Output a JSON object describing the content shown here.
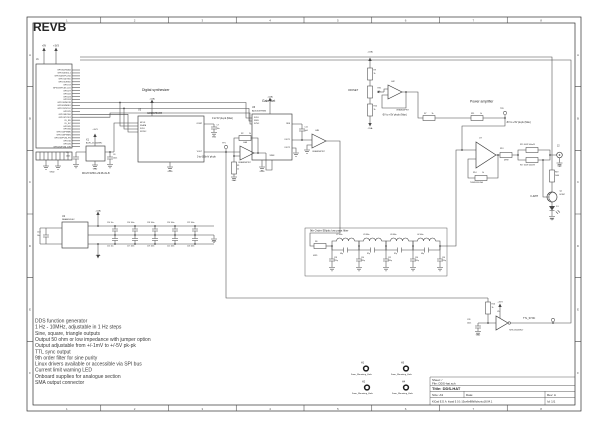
{
  "rev_label": "REVB",
  "features": [
    "DDS function generator",
    "1 Hz - 10MHz, adjustable in 1 Hz steps",
    "Sine, square, triangle outputs",
    "Output 50 ohm or low impedance with jumper option",
    "Output adjustable from +/-1mV to +/-5V pk-pk",
    "TTL sync output",
    "9th order filter for sine purity",
    "Linux drivers available or accessible via SPI bus",
    "Current limit warning LED",
    "Onboard supplies for analogue section",
    "SMA output connector"
  ],
  "title_block": {
    "sheet": "Sheet: /",
    "file": "File: DDS-hat.sch",
    "title": "Title: DDS-HAT",
    "size": "Size: A3",
    "date": "Date:",
    "rev": "Rev: A",
    "tool": "KiCad E.D.A.  kicad 5.0.1-15ce6e88b8ubuntu18.04.1",
    "id": "Id: 1/1"
  },
  "frame": {
    "cols": [
      "1",
      "2",
      "3",
      "4",
      "5",
      "6",
      "7",
      "8"
    ],
    "rows": [
      "A",
      "B",
      "C",
      "D",
      "E",
      "F"
    ]
  },
  "gpio_header": {
    "pins": [
      "GPIO02/SDA1",
      "GPIO03/SCL1",
      "GPIO04/GPCLK0",
      "GPIO14/TXD",
      "GPIO15/RXD",
      "GPIO17",
      "GPIO18/PCM_CLK",
      "GPIO27",
      "GPIO22",
      "GPIO23",
      "GPIO24",
      "GPIO10/MOSI",
      "GPIO09/MISO",
      "GPIO11/SCLK",
      "GPIO25",
      "GPIO08/CE0",
      "GPIO07/CE1",
      "ID_SD",
      "ID_SC",
      "GPIO05",
      "GPIO06",
      "GPIO12/PWM0",
      "GPIO13/PWM1",
      "GPIO19/PCM_FS",
      "GPIO16",
      "GPIO26",
      "GPIO20/PCM_DIN"
    ]
  },
  "colors": {
    "line": "#474747",
    "text": "#262626",
    "frame": "#2f2f2f"
  },
  "labels": [
    {
      "t": "REVB",
      "x": 33,
      "y": 21,
      "fs": 12,
      "b": 1,
      "n": "rev-label"
    },
    {
      "t": "Digital synthesizer",
      "x": 142,
      "y": 88,
      "fs": 3.4,
      "n": "label-digital-synthesizer"
    },
    {
      "t": "Gain Set",
      "x": 262,
      "y": 99,
      "fs": 3.4,
      "n": "label-gain-set"
    },
    {
      "t": "Power amplifier",
      "x": 470,
      "y": 99.5,
      "fs": 3.4,
      "n": "label-power-amplifier"
    },
    {
      "t": "9th Order Elliptic low pass filter",
      "x": 310,
      "y": 229,
      "fs": 2.8,
      "n": "label-filter"
    },
    {
      "t": "0 to 600mV pk-pk",
      "x": 197,
      "y": 155.5,
      "fs": 2.4
    },
    {
      "t": "0 to 5V pk-pk (Max)",
      "x": 212,
      "y": 117,
      "fs": 2.4
    },
    {
      "t": "-5V to +5V pk-pk (Max)",
      "x": 382,
      "y": 113.5,
      "fs": 2.4
    },
    {
      "t": "-5V to +5V pk-pk (Max)",
      "x": 506,
      "y": 121,
      "fs": 2.4
    },
    {
      "t": "OFFSET",
      "x": 348,
      "y": 89,
      "fs": 2.6
    },
    {
      "t": "I LIMIT",
      "x": 530,
      "y": 195,
      "fs": 2.6
    },
    {
      "t": "MCLH-WHC1-29.08-JG-B",
      "x": 82,
      "y": 172,
      "fs": 2.4
    },
    {
      "t": "J1",
      "x": 36,
      "y": 58,
      "fs": 2.6
    },
    {
      "t": "+5V",
      "x": 44,
      "y": 44.5,
      "fs": 2.4,
      "a": "m"
    },
    {
      "t": "+3V3",
      "x": 56,
      "y": 44.5,
      "fs": 2.4,
      "a": "m"
    },
    {
      "t": "GND",
      "x": 52,
      "y": 170.5,
      "fs": 2.2,
      "a": "m"
    },
    {
      "t": "X1",
      "x": 86,
      "y": 138.5,
      "fs": 2.4
    },
    {
      "t": "ACHL-25.000MHz",
      "x": 86,
      "y": 141.8,
      "fs": 2
    },
    {
      "t": "+3V3",
      "x": 95,
      "y": 128,
      "fs": 2.2,
      "a": "m"
    },
    {
      "t": "C5",
      "x": 66,
      "y": 151.5,
      "fs": 1.9
    },
    {
      "t": "100n",
      "x": 66,
      "y": 154.8,
      "fs": 1.9
    },
    {
      "t": "C6",
      "x": 113,
      "y": 153.5,
      "fs": 1.9
    },
    {
      "t": "100n",
      "x": 113,
      "y": 156.8,
      "fs": 1.9
    },
    {
      "t": "GND",
      "x": 95,
      "y": 168,
      "fs": 2,
      "a": "m"
    },
    {
      "t": "U3",
      "x": 138,
      "y": 108.5,
      "fs": 2.4
    },
    {
      "t": "AD9837BCPZ",
      "x": 147,
      "y": 112.2,
      "fs": 2.4
    },
    {
      "t": "MCLK",
      "x": 140,
      "y": 121.6,
      "fs": 1.9
    },
    {
      "t": "SDATA",
      "x": 140,
      "y": 124.6,
      "fs": 1.9
    },
    {
      "t": "SCLK",
      "x": 140,
      "y": 127.6,
      "fs": 1.9
    },
    {
      "t": "FSYNC",
      "x": 140,
      "y": 130.6,
      "fs": 1.9
    },
    {
      "t": "COMP",
      "x": 202,
      "y": 122.6,
      "fs": 1.9,
      "a": "e"
    },
    {
      "t": "VOUT",
      "x": 202,
      "y": 150.6,
      "fs": 1.9,
      "a": "e"
    },
    {
      "t": "+5VA",
      "x": 152,
      "y": 97.5,
      "fs": 2.2,
      "a": "m"
    },
    {
      "t": "C7",
      "x": 216.5,
      "y": 124,
      "fs": 1.9
    },
    {
      "t": "10n",
      "x": 216.5,
      "y": 127.3,
      "fs": 1.9
    },
    {
      "t": "GND",
      "x": 214,
      "y": 136,
      "fs": 1.9,
      "a": "m"
    },
    {
      "t": "TP1",
      "x": 222,
      "y": 142,
      "fs": 2
    },
    {
      "t": "GND",
      "x": 170,
      "y": 170,
      "fs": 2.2,
      "a": "m"
    },
    {
      "t": "U4A",
      "x": 243,
      "y": 141.5,
      "fs": 2
    },
    {
      "t": "OPA4820IPWT",
      "x": 238,
      "y": 161.5,
      "fs": 1.9
    },
    {
      "t": "R2",
      "x": 241,
      "y": 132.6,
      "fs": 1.9
    },
    {
      "t": "2k",
      "x": 249,
      "y": 132.6,
      "fs": 1.9
    },
    {
      "t": "R1",
      "x": 237,
      "y": 164.5,
      "fs": 1.9
    },
    {
      "t": "1k",
      "x": 237,
      "y": 167.8,
      "fs": 1.9
    },
    {
      "t": "GND",
      "x": 234,
      "y": 179.5,
      "fs": 2,
      "a": "m"
    },
    {
      "t": "U6",
      "x": 252,
      "y": 106,
      "fs": 2.4
    },
    {
      "t": "AD5453YRMZ",
      "x": 252,
      "y": 109.6,
      "fs": 2.2
    },
    {
      "t": "SCLK",
      "x": 254,
      "y": 116.6,
      "fs": 1.9
    },
    {
      "t": "SDIN",
      "x": 254,
      "y": 119.6,
      "fs": 1.9
    },
    {
      "t": "SYNC",
      "x": 254,
      "y": 122.6,
      "fs": 1.9
    },
    {
      "t": "RFB",
      "x": 290,
      "y": 122.6,
      "fs": 1.9,
      "a": "e"
    },
    {
      "t": "IOUT1",
      "x": 290,
      "y": 138.6,
      "fs": 1.9,
      "a": "e"
    },
    {
      "t": "IOUT2",
      "x": 290,
      "y": 146.6,
      "fs": 1.9,
      "a": "e"
    },
    {
      "t": "VREF",
      "x": 272,
      "y": 154.6,
      "fs": 1.9,
      "a": "m"
    },
    {
      "t": "+5VA",
      "x": 270,
      "y": 95.5,
      "fs": 2.2,
      "a": "m"
    },
    {
      "t": "GND",
      "x": 262,
      "y": 170,
      "fs": 2.2,
      "a": "m"
    },
    {
      "t": "C11",
      "x": 304.5,
      "y": 126,
      "fs": 1.9
    },
    {
      "t": "6p8",
      "x": 304.5,
      "y": 129.3,
      "fs": 1.9
    },
    {
      "t": "U4B",
      "x": 315,
      "y": 129.5,
      "fs": 2
    },
    {
      "t": "OPA4820IPWT",
      "x": 312,
      "y": 150.5,
      "fs": 1.9
    },
    {
      "t": "+5VA",
      "x": 370,
      "y": 50.5,
      "fs": 2.2,
      "a": "m"
    },
    {
      "t": "R9",
      "x": 373.5,
      "y": 69,
      "fs": 1.9
    },
    {
      "t": "1k",
      "x": 373.5,
      "y": 72.3,
      "fs": 1.9
    },
    {
      "t": "RV1",
      "x": 377.5,
      "y": 87,
      "fs": 1.9
    },
    {
      "t": "10k",
      "x": 377.5,
      "y": 90.3,
      "fs": 1.9
    },
    {
      "t": "R10",
      "x": 373.5,
      "y": 105,
      "fs": 1.9
    },
    {
      "t": "1k",
      "x": 373.5,
      "y": 108.3,
      "fs": 1.9
    },
    {
      "t": "-5VA",
      "x": 370,
      "y": 127,
      "fs": 2.2,
      "a": "m"
    },
    {
      "t": "U4C",
      "x": 391,
      "y": 80.5,
      "fs": 2
    },
    {
      "t": "OPA4820IPWT",
      "x": 396,
      "y": 109,
      "fs": 1.9
    },
    {
      "t": "R7",
      "x": 424,
      "y": 112.3,
      "fs": 1.9
    },
    {
      "t": "1k",
      "x": 431.5,
      "y": 112.3,
      "fs": 1.9
    },
    {
      "t": "R11",
      "x": 471,
      "y": 112.3,
      "fs": 1.9
    },
    {
      "t": "1k",
      "x": 480,
      "y": 112.3,
      "fs": 1.9
    },
    {
      "t": "TP6",
      "x": 500,
      "y": 107.5,
      "fs": 2
    },
    {
      "t": "U7",
      "x": 479,
      "y": 136.5,
      "fs": 2.2
    },
    {
      "t": "THS3091DDA",
      "x": 470,
      "y": 181.5,
      "fs": 2
    },
    {
      "t": "R14",
      "x": 473,
      "y": 171.5,
      "fs": 1.9
    },
    {
      "t": "1k",
      "x": 482,
      "y": 171.5,
      "fs": 1.9
    },
    {
      "t": "R13",
      "x": 500,
      "y": 147.5,
      "fs": 1.9
    },
    {
      "t": "49R9",
      "x": 504,
      "y": 159,
      "fs": 1.9
    },
    {
      "t": "R15 100R 500mW",
      "x": 520,
      "y": 143.5,
      "fs": 1.8
    },
    {
      "t": "R17 100R 500mW",
      "x": 520,
      "y": 163.8,
      "fs": 1.8
    },
    {
      "t": "J2",
      "x": 557,
      "y": 144.5,
      "fs": 2.4
    },
    {
      "t": "GND",
      "x": 559.5,
      "y": 165,
      "fs": 2,
      "a": "m"
    },
    {
      "t": "R19",
      "x": 555,
      "y": 171,
      "fs": 1.9
    },
    {
      "t": "1k00",
      "x": 555,
      "y": 174.3,
      "fs": 1.9
    },
    {
      "t": "Q1",
      "x": 559.5,
      "y": 190,
      "fs": 2
    },
    {
      "t": "BC847",
      "x": 559.5,
      "y": 193.3,
      "fs": 1.8
    },
    {
      "t": "D1",
      "x": 556,
      "y": 205.5,
      "fs": 2
    },
    {
      "t": "GND",
      "x": 552,
      "y": 218,
      "fs": 2,
      "a": "m"
    },
    {
      "t": "R16",
      "x": 491.5,
      "y": 303,
      "fs": 1.9
    },
    {
      "t": "1k",
      "x": 491.5,
      "y": 306.3,
      "fs": 1.9
    },
    {
      "t": "+3V3",
      "x": 500,
      "y": 300.5,
      "fs": 2.2,
      "a": "m"
    },
    {
      "t": "C26",
      "x": 467,
      "y": 318.5,
      "fs": 1.9
    },
    {
      "t": "100n",
      "x": 467,
      "y": 321.8,
      "fs": 1.9
    },
    {
      "t": "GND",
      "x": 478,
      "y": 334,
      "fs": 2,
      "a": "m"
    },
    {
      "t": "U5",
      "x": 497,
      "y": 310.5,
      "fs": 2
    },
    {
      "t": "74HC1G04GW-T",
      "x": 509,
      "y": 329,
      "fs": 1.9
    },
    {
      "t": "TTL_SYNC",
      "x": 523,
      "y": 317,
      "fs": 2.4
    },
    {
      "t": "U2",
      "x": 62,
      "y": 215,
      "fs": 2.4
    },
    {
      "t": "NMA0505SC",
      "x": 62,
      "y": 218.4,
      "fs": 2.2
    },
    {
      "t": "C13",
      "x": 37,
      "y": 231,
      "fs": 1.9
    },
    {
      "t": "10u",
      "x": 37,
      "y": 234.3,
      "fs": 1.9
    },
    {
      "t": "+5VA",
      "x": 98,
      "y": 209.5,
      "fs": 2.2,
      "a": "m"
    },
    {
      "t": "-5VA",
      "x": 98,
      "y": 254,
      "fs": 2.2,
      "a": "m"
    },
    {
      "t": "GND",
      "x": 214,
      "y": 240.5,
      "fs": 2,
      "a": "m"
    },
    {
      "t": "C14 10u",
      "x": 107,
      "y": 221.5,
      "fs": 1.7
    },
    {
      "t": "C16 100n",
      "x": 127,
      "y": 221.5,
      "fs": 1.7
    },
    {
      "t": "C18 100n",
      "x": 147,
      "y": 221.5,
      "fs": 1.7
    },
    {
      "t": "C20 100n",
      "x": 167,
      "y": 221.5,
      "fs": 1.7
    },
    {
      "t": "C22 100n",
      "x": 187,
      "y": 221.5,
      "fs": 1.7
    },
    {
      "t": "C15 10u",
      "x": 107,
      "y": 245,
      "fs": 1.7
    },
    {
      "t": "C17 100n",
      "x": 127,
      "y": 245,
      "fs": 1.7
    },
    {
      "t": "C19 100n",
      "x": 147,
      "y": 245,
      "fs": 1.7
    },
    {
      "t": "C21 100n",
      "x": 167,
      "y": 245,
      "fs": 1.7
    },
    {
      "t": "C23 100n",
      "x": 187,
      "y": 245,
      "fs": 1.7
    },
    {
      "t": "R6",
      "x": 315,
      "y": 240.5,
      "fs": 1.9
    },
    {
      "t": "49R9",
      "x": 313,
      "y": 254.5,
      "fs": 1.8
    },
    {
      "t": "L1 560n",
      "x": 336,
      "y": 233.5,
      "fs": 1.8
    },
    {
      "t": "L2 680n",
      "x": 363,
      "y": 233.5,
      "fs": 1.8
    },
    {
      "t": "L3 680n",
      "x": 390,
      "y": 233.5,
      "fs": 1.8
    },
    {
      "t": "L4 560n",
      "x": 417,
      "y": 233.5,
      "fs": 1.8
    },
    {
      "t": "68p",
      "x": 340,
      "y": 252.5,
      "fs": 1.7
    },
    {
      "t": "82p",
      "x": 367,
      "y": 252.5,
      "fs": 1.7
    },
    {
      "t": "82p",
      "x": 394,
      "y": 252.5,
      "fs": 1.7
    },
    {
      "t": "68p",
      "x": 421,
      "y": 252.5,
      "fs": 1.7
    },
    {
      "t": "C28",
      "x": 334,
      "y": 256.5,
      "fs": 1.7
    },
    {
      "t": "220p",
      "x": 334,
      "y": 259.7,
      "fs": 1.7
    },
    {
      "t": "C30",
      "x": 361,
      "y": 256.5,
      "fs": 1.7
    },
    {
      "t": "330p",
      "x": 361,
      "y": 259.7,
      "fs": 1.7
    },
    {
      "t": "C32",
      "x": 388,
      "y": 256.5,
      "fs": 1.7
    },
    {
      "t": "330p",
      "x": 388,
      "y": 259.7,
      "fs": 1.7
    },
    {
      "t": "C34",
      "x": 415,
      "y": 256.5,
      "fs": 1.7
    },
    {
      "t": "330p",
      "x": 415,
      "y": 259.7,
      "fs": 1.7
    },
    {
      "t": "C36",
      "x": 442,
      "y": 256.5,
      "fs": 1.7
    },
    {
      "t": "220p",
      "x": 442,
      "y": 259.7,
      "fs": 1.7
    },
    {
      "t": "H1",
      "x": 361,
      "y": 361.5,
      "fs": 2.4
    },
    {
      "t": "H3",
      "x": 401,
      "y": 361.5,
      "fs": 2.4
    },
    {
      "t": "H2",
      "x": 362,
      "y": 380.5,
      "fs": 2.4
    },
    {
      "t": "H4",
      "x": 402,
      "y": 380.5,
      "fs": 2.4
    },
    {
      "t": "3mm_Mounting_Hole",
      "x": 351,
      "y": 373,
      "fs": 2.2
    },
    {
      "t": "3mm_Mounting_Hole",
      "x": 391,
      "y": 373,
      "fs": 2.2
    },
    {
      "t": "3mm_Mounting_Hole",
      "x": 352,
      "y": 392,
      "fs": 2.2
    },
    {
      "t": "3mm_Mounting_Hole",
      "x": 392,
      "y": 392,
      "fs": 2.2
    }
  ]
}
